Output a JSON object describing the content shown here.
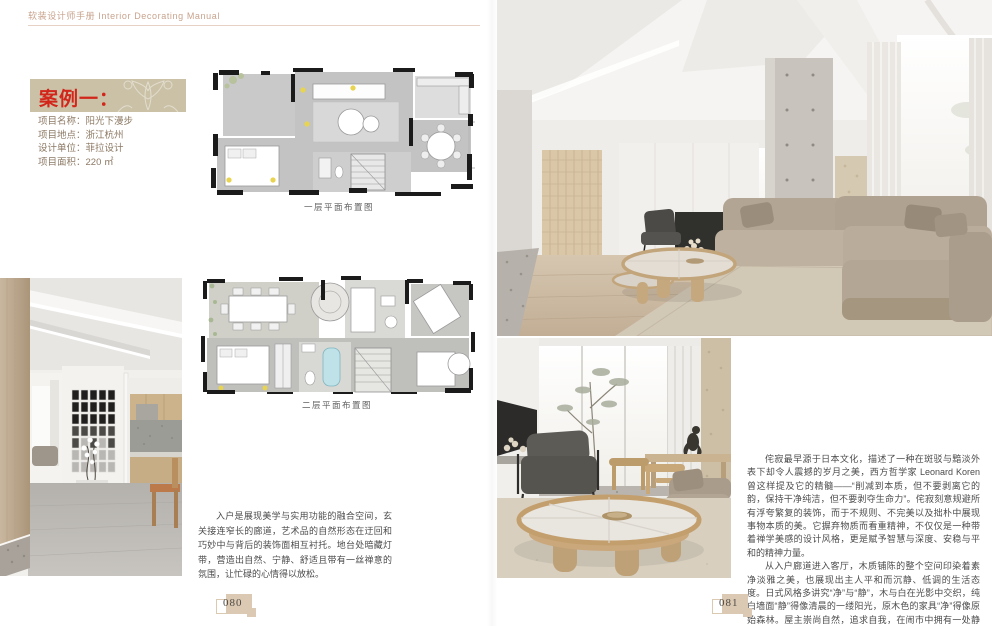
{
  "header": {
    "title": "软装设计师手册 Interior Decorating Manual"
  },
  "left_page": {
    "page_number": "080",
    "case_label": "案例一：",
    "project_info": {
      "name": "项目名称：阳光下漫步",
      "location": "项目地点：浙江杭州",
      "designer": "设计单位：菲拉设计",
      "area": "项目面积：220 ㎡"
    },
    "plan1_caption": "一层平面布置图",
    "plan2_caption": "二层平面布置图",
    "body_text": "入户是展现美学与实用功能的融合空间，玄关接连窄长的廊道，艺术品的自然形态在迂回和巧妙中与背后的装饰面相互衬托。地台处暗藏灯带，营造出自然、宁静、舒适且带有一丝禅意的氛围，让忙碌的心情得以放松。"
  },
  "right_page": {
    "page_number": "081",
    "paragraph1": "侘寂最早源于日本文化，描述了一种在斑驳与黯淡外表下却令人震撼的岁月之美，西方哲学家 Leonard Koren 曾这样提及它的精髓——“削减到本质，但不要剥离它的韵，保持干净纯洁，但不要剥夺生命力”。侘寂刻意规避所有浮夸繁复的装饰，而于不规则、不完美以及拙朴中展现事物本质的美。它摒弃物质而看重精神，不仅仅是一种带着禅学美感的设计风格，更是赋予智慧与深度、安稳与平和的精神力量。",
    "paragraph2": "从入户廊道进入客厅，木质铺陈的整个空间印染着素净淡雅之美，也展现出主人平和而沉静、低调的生活态度。日式风格多讲究“净”与“静”，木与白在光影中交织，纯白墙面“静”得像清晨的一缕阳光，原木色的家具“净”得像原始森林。屋主崇尚自然，追求自我，在闹市中拥有一处静谧，是他向往的生活方式。"
  },
  "colors": {
    "accent_red": "#d2261b",
    "title_box_bg": "#cbc1a6",
    "header_text": "#c8a38d",
    "info_text": "#8d7a65",
    "body_text": "#4c4c4c",
    "badge_tan": "#dcc9b3"
  }
}
